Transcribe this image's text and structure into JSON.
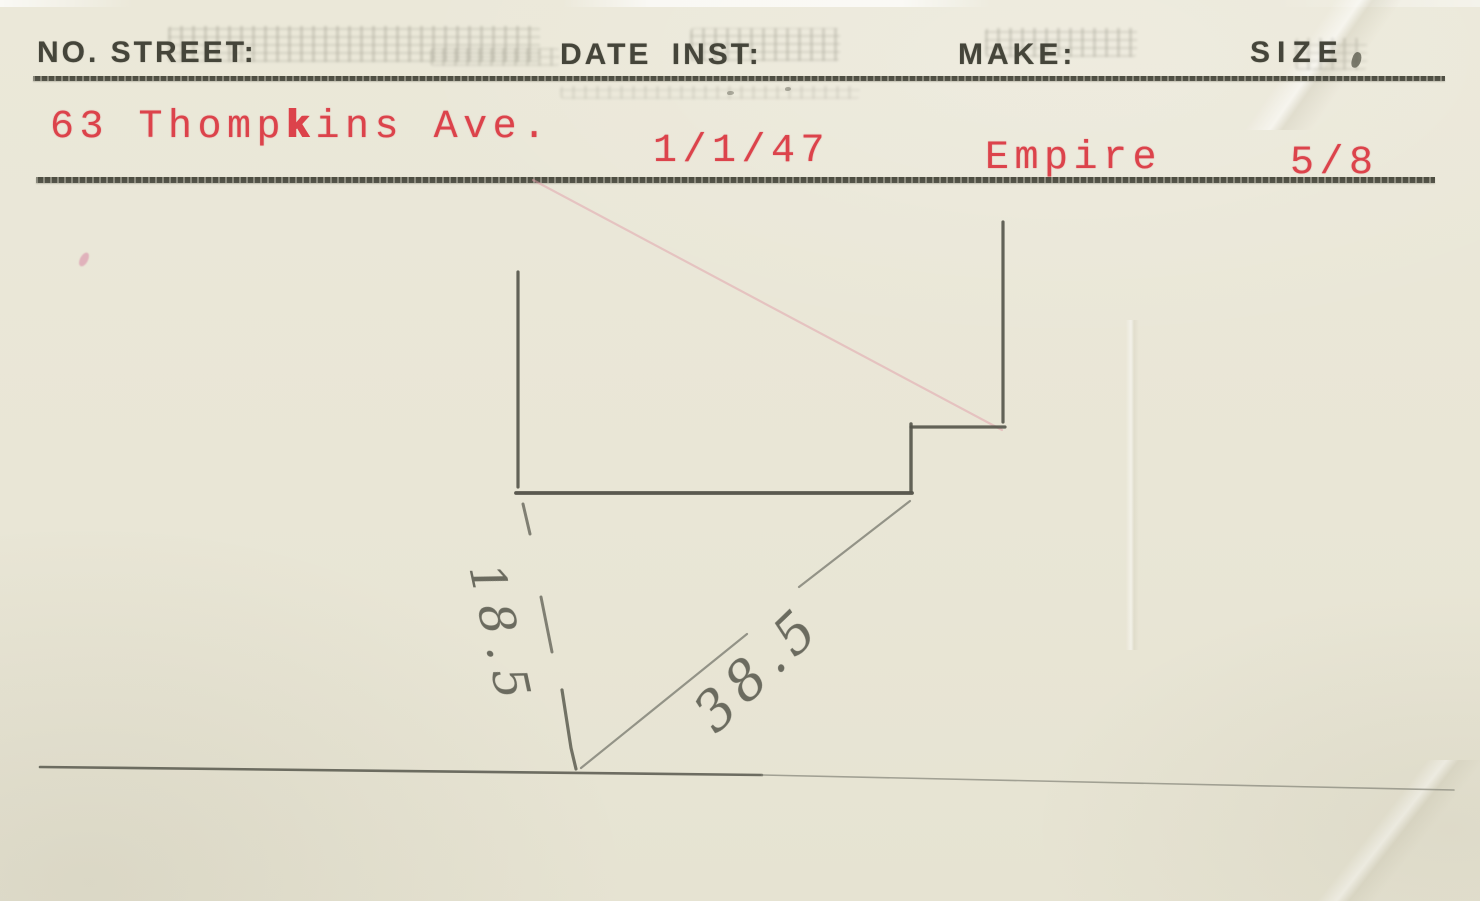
{
  "card": {
    "header": {
      "no_street_label": "NO. STREET:",
      "date_inst_label": "DATE INST:",
      "make_label": "MAKE:",
      "size_label": "SIZE"
    },
    "values": {
      "street_prefix": "63 Thomp",
      "street_overstrike": "k",
      "street_suffix": "ins Ave.",
      "date_inst": "1/1/47",
      "make": "Empire",
      "size": "5/8"
    },
    "sketch": {
      "vertical_dim": "18.5",
      "diagonal_dim": "38.5"
    },
    "colors": {
      "paper": "#e9e6d6",
      "print_ink": "#45453a",
      "red_ink": "#dc434b",
      "pencil_dark": "#54544a",
      "pencil_light": "#85857a",
      "pink_trace": "#e2a0aa"
    }
  }
}
